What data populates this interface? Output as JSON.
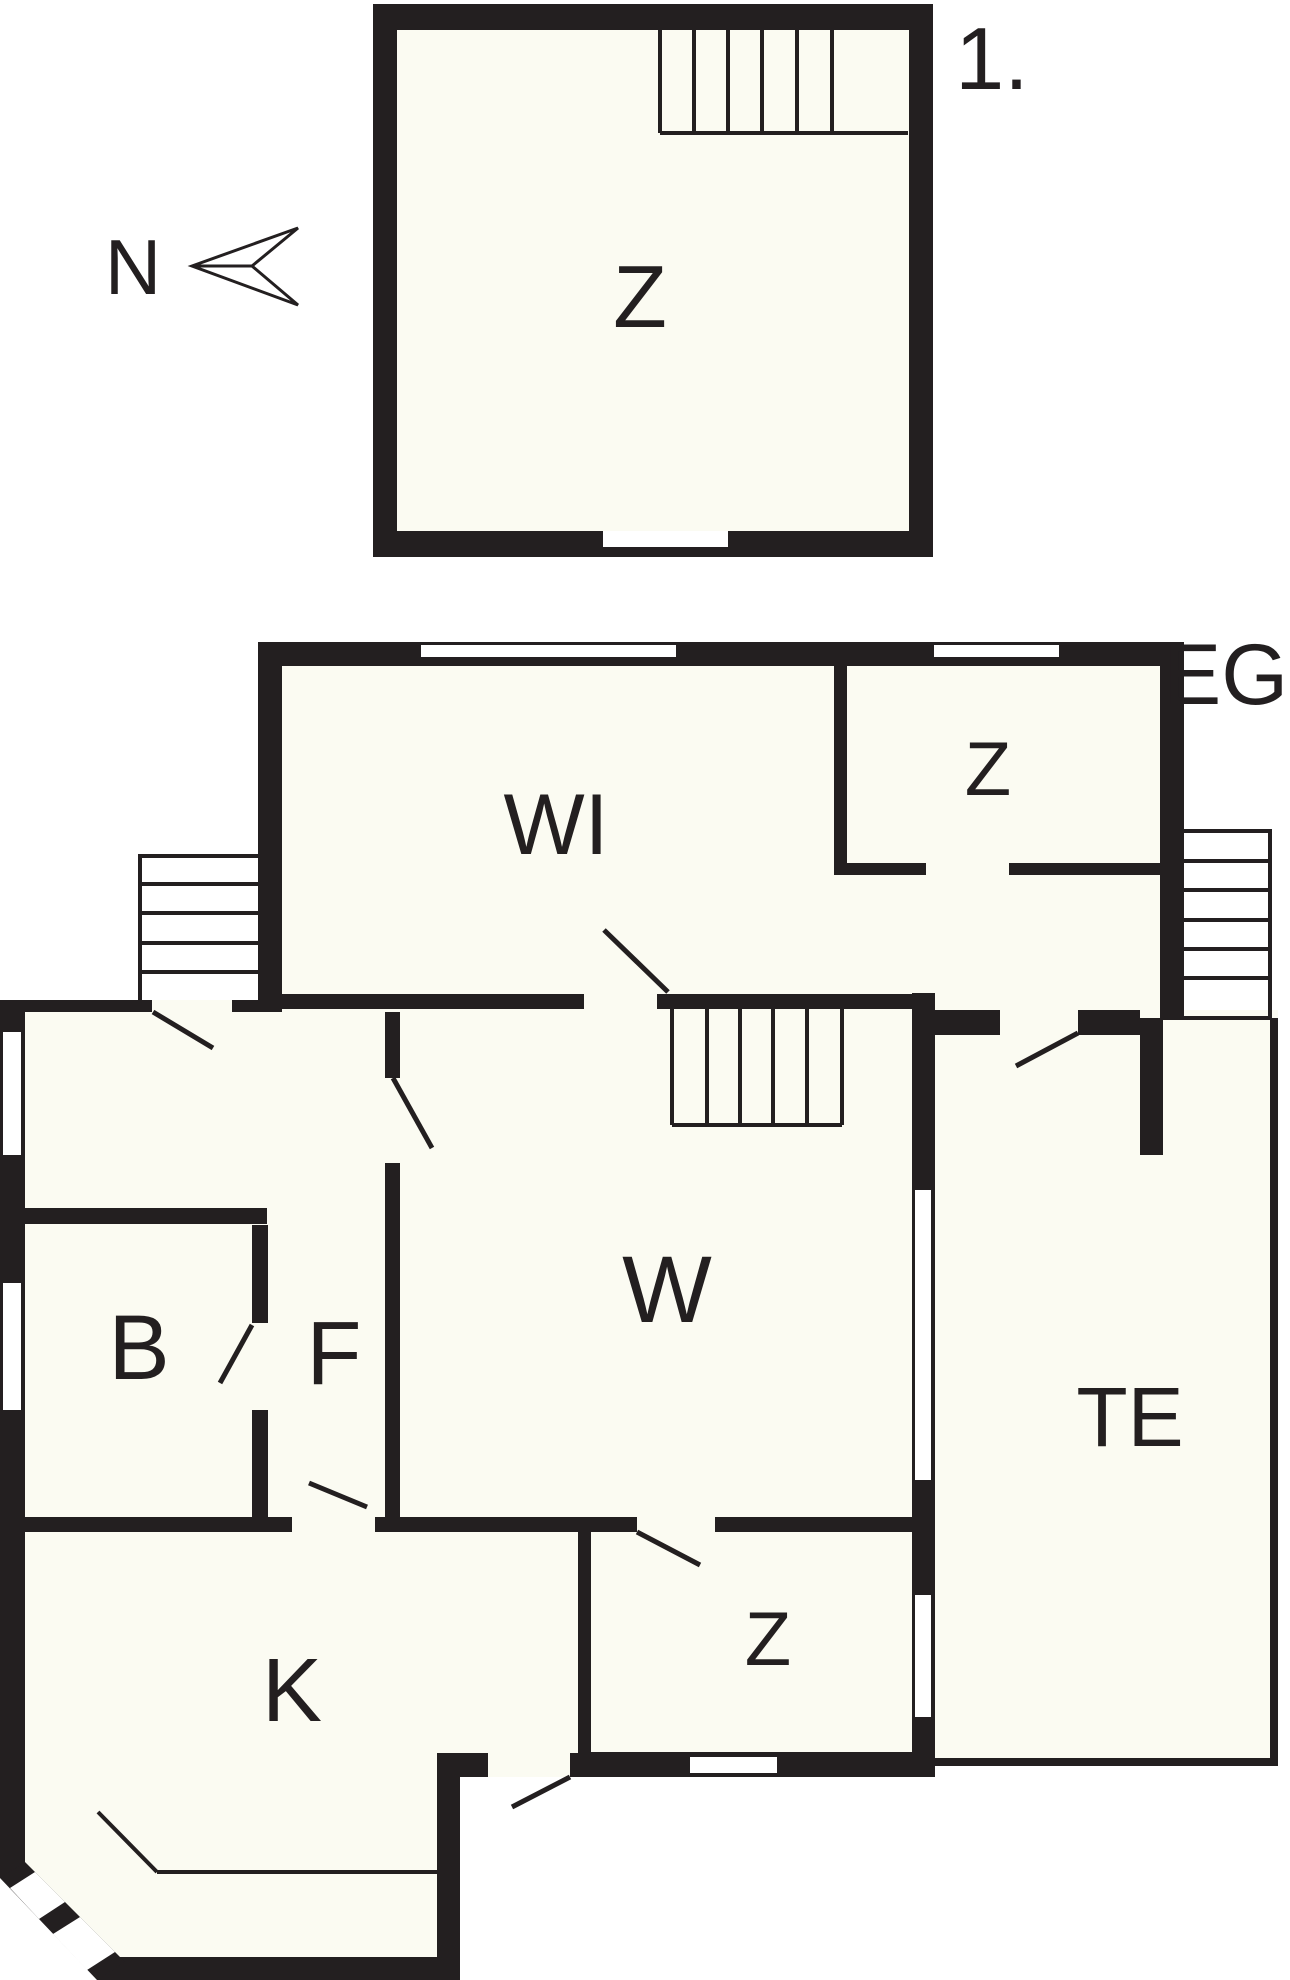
{
  "plan": {
    "ink": "#231f20",
    "floor_fill": "#fbfbf2",
    "outside": "#ffffff",
    "floors": [
      {
        "id": "upper-floor",
        "name_label": "1."
      },
      {
        "id": "ground-floor",
        "name_label": "EG"
      }
    ],
    "north_indicator": {
      "label": "N"
    },
    "labels": [
      {
        "id": "floor-1-label",
        "text": "1.",
        "x": 992,
        "y": 89,
        "size": 88
      },
      {
        "id": "north-label",
        "text": "N",
        "x": 133,
        "y": 294,
        "size": 78
      },
      {
        "id": "room-z-upper",
        "text": "Z",
        "x": 640,
        "y": 327,
        "size": 88
      },
      {
        "id": "floor-eg-label",
        "text": "EG",
        "x": 1226,
        "y": 704,
        "size": 86
      },
      {
        "id": "room-wi",
        "text": "WI",
        "x": 556,
        "y": 854,
        "size": 86
      },
      {
        "id": "room-z-eg-top",
        "text": "Z",
        "x": 988,
        "y": 795,
        "size": 76
      },
      {
        "id": "room-w",
        "text": "W",
        "x": 667,
        "y": 1322,
        "size": 95
      },
      {
        "id": "room-b",
        "text": "B",
        "x": 139,
        "y": 1379,
        "size": 92
      },
      {
        "id": "room-f",
        "text": "F",
        "x": 334,
        "y": 1384,
        "size": 90
      },
      {
        "id": "room-k",
        "text": "K",
        "x": 292,
        "y": 1721,
        "size": 90
      },
      {
        "id": "room-z-eg-bottom",
        "text": "Z",
        "x": 768,
        "y": 1665,
        "size": 76
      },
      {
        "id": "room-te",
        "text": "TE",
        "x": 1130,
        "y": 1446,
        "size": 84
      }
    ]
  }
}
